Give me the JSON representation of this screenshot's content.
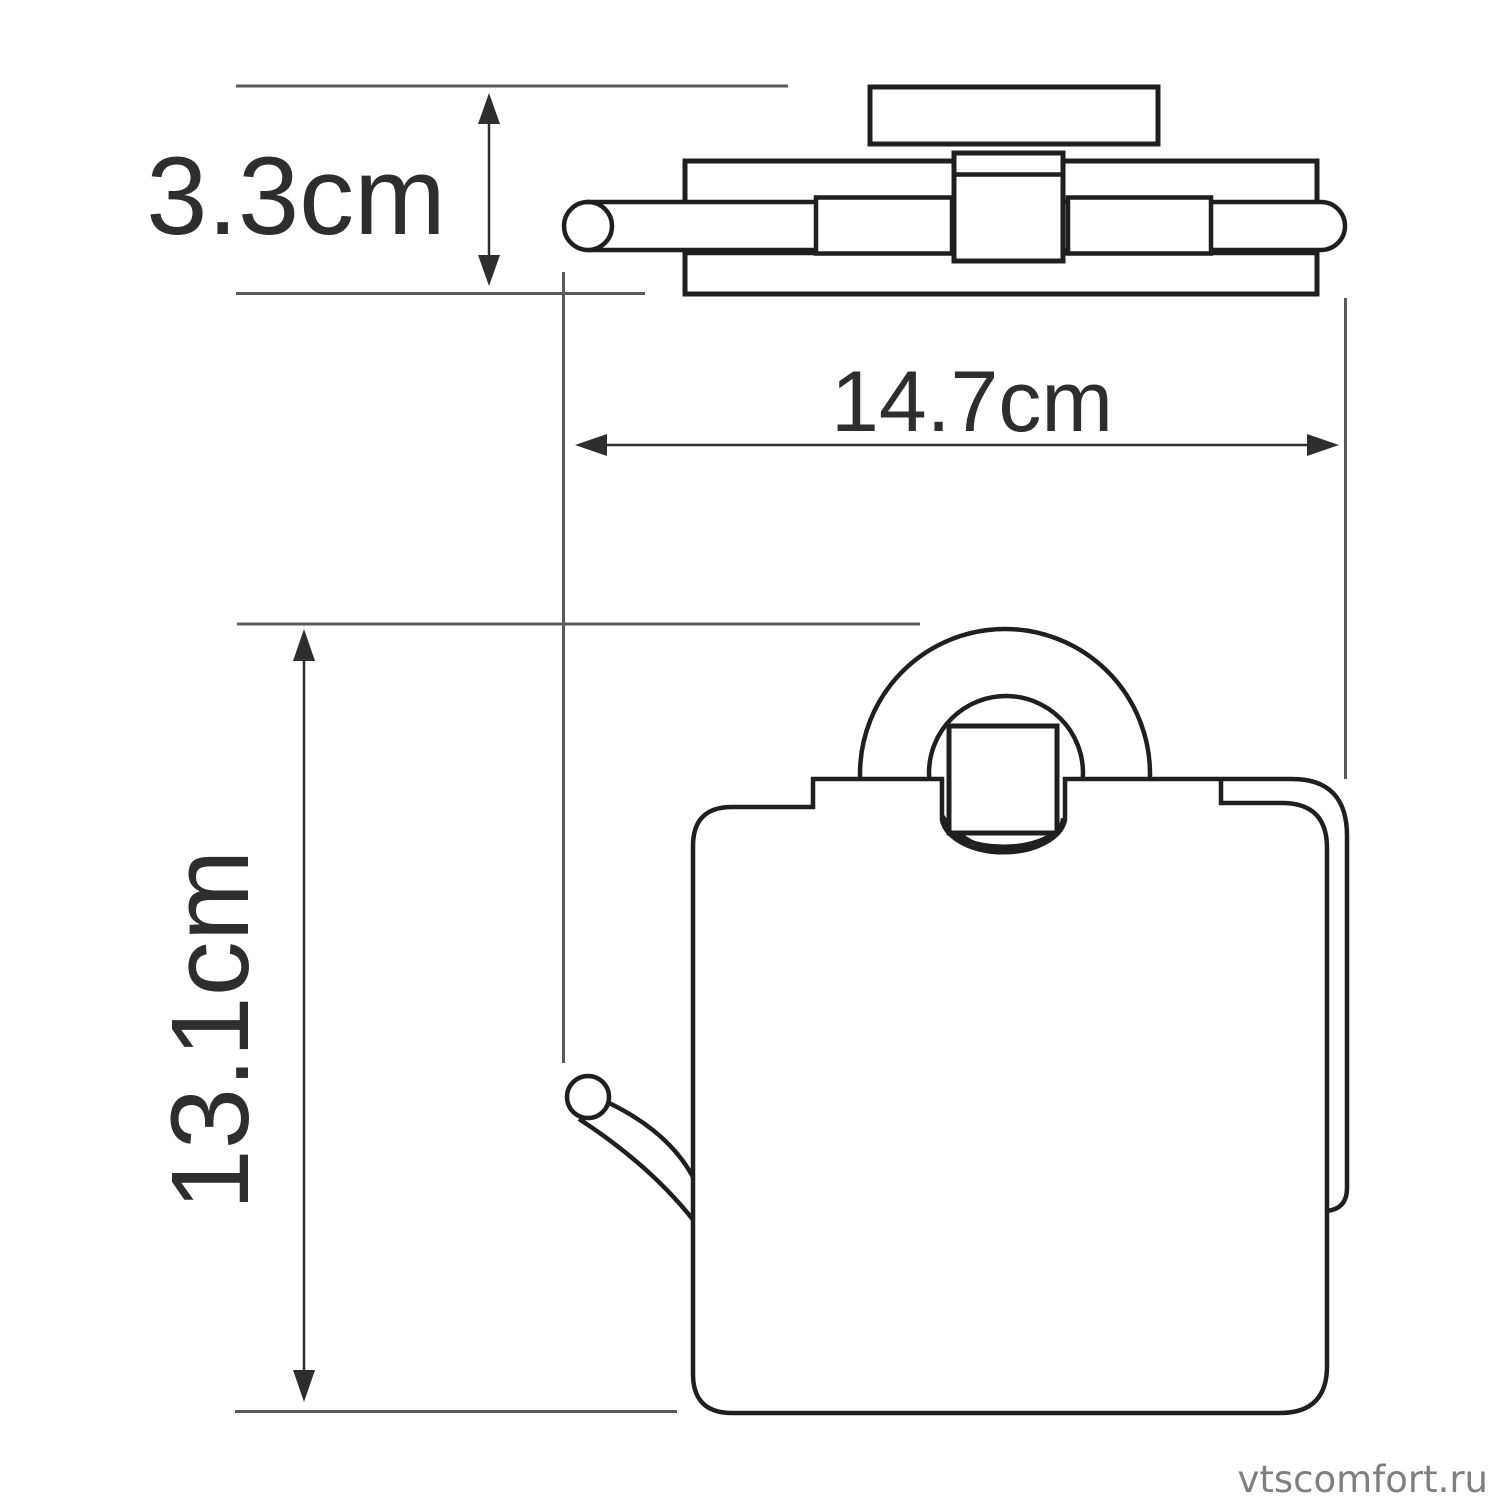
{
  "dimensions": {
    "depth": {
      "label": "3.3cm"
    },
    "width": {
      "label": "14.7cm"
    },
    "height": {
      "label": "13.1cm"
    }
  },
  "watermark": {
    "text": "vtscomfort.ru",
    "color": "#7f7f7f"
  },
  "colors": {
    "outline": "#1f1f1f",
    "extension_line": "#5a5a5a",
    "dimension_line": "#2e2e2e",
    "label_text": "#2e2e2e",
    "background": "#ffffff"
  }
}
